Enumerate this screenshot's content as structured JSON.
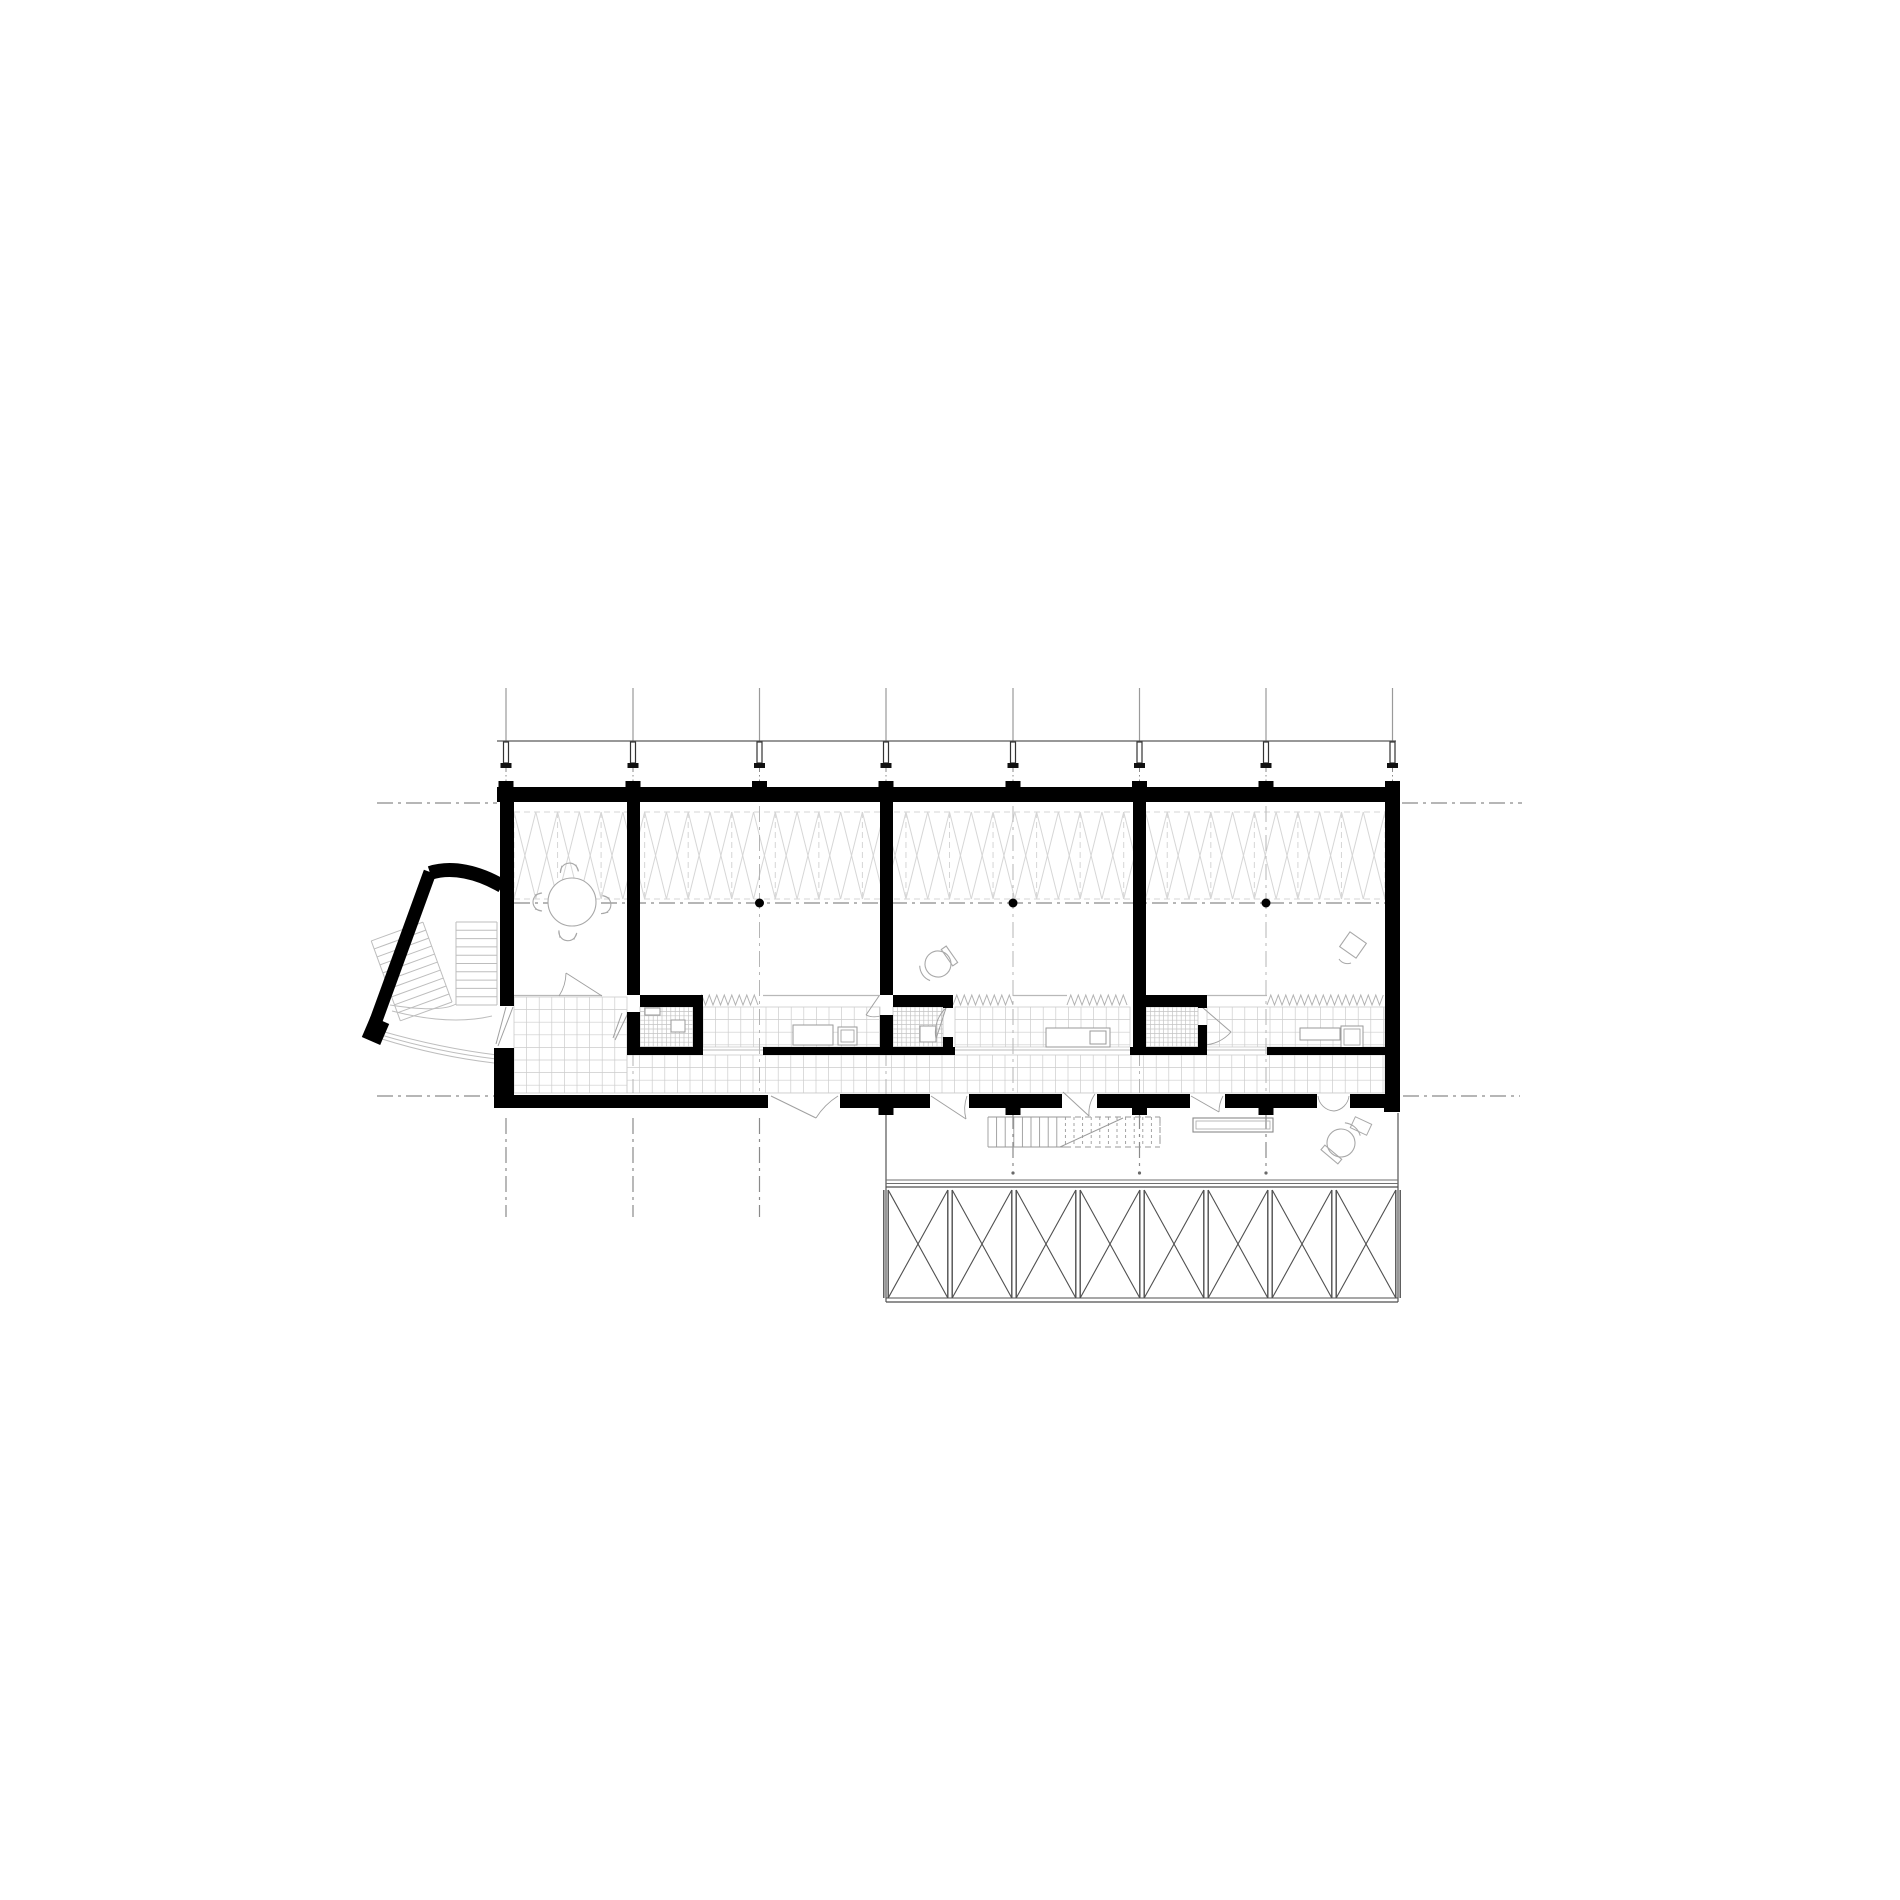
{
  "meta": {
    "type": "architectural-floor-plan",
    "canvas": {
      "w": 1900,
      "h": 1900,
      "background": "#ffffff"
    }
  },
  "colors": {
    "wall": "#000000",
    "axis": "#8a8a8a",
    "riser": "#9a9a9a",
    "canopy": "#5a5a5a",
    "truss": "#d6d6d6",
    "tile": "#cccccc",
    "tile_fine": "#c4c4c4",
    "furniture": "#a8a8a8",
    "door": "#a0a0a0",
    "deck": "#4f4f4f",
    "deck_light": "#9a9a9a",
    "stair": "#bdbdbd",
    "zigzag": "#b2b2b2",
    "fixture_border": "#9a9a9a"
  },
  "grid": {
    "x": [
      506,
      633,
      759.5,
      886,
      1013,
      1139.5,
      1266,
      1392.5
    ],
    "riser": [
      688,
      741
    ],
    "upper_dashdot": [
      768,
      787
    ],
    "interior_lines": [
      [
        2,
        806,
        1093
      ],
      [
        4,
        806,
        1093
      ],
      [
        6,
        806,
        1093
      ],
      [
        1,
        1050,
        1093
      ],
      [
        3,
        1050,
        1115
      ],
      [
        5,
        1050,
        1093
      ]
    ],
    "below_lines": [
      [
        0,
        1118,
        1217
      ],
      [
        1,
        1118,
        1217
      ],
      [
        2,
        1118,
        1217
      ]
    ],
    "deck_lines": [
      [
        4,
        1113,
        1171
      ],
      [
        5,
        1113,
        1171
      ],
      [
        6,
        1113,
        1171
      ]
    ]
  },
  "axes": {
    "horizontal": [
      {
        "name": "top-axis-left",
        "y": 803,
        "x1": 377,
        "x2": 497
      },
      {
        "name": "top-axis-right",
        "y": 803,
        "x1": 1402,
        "x2": 1522
      },
      {
        "name": "bottom-axis-left",
        "y": 1096,
        "x1": 377,
        "x2": 498
      },
      {
        "name": "bottom-axis-right",
        "y": 1096,
        "x1": 1403,
        "x2": 1520
      },
      {
        "name": "mid-axis",
        "y": 903,
        "x1": 514,
        "x2": 1385
      }
    ],
    "dots": [
      [
        759.5,
        903
      ],
      [
        1013,
        903
      ],
      [
        1266,
        903
      ]
    ]
  },
  "canopy": {
    "y": 741,
    "x1": 497,
    "x2": 1396
  },
  "columns": {
    "shaft_w": 5,
    "y1": 742,
    "y2": 763,
    "flange_w": 11,
    "flange_h": 5,
    "pad": {
      "y": 781,
      "w": 15,
      "h": 6
    }
  },
  "walls": {
    "rects": [
      [
        497,
        787,
        903,
        15,
        "top-exterior-wall"
      ],
      [
        500,
        787,
        14,
        219,
        "left-exterior-wall"
      ],
      [
        494,
        1048,
        20,
        60,
        "left-entry-pier"
      ],
      [
        1385,
        787,
        15,
        325,
        "right-exterior-wall"
      ],
      [
        498,
        1095,
        270,
        13,
        "bottom-exterior-wall-solid"
      ],
      [
        1384,
        1095,
        16,
        17,
        "bottom-right-corner"
      ],
      [
        627,
        800,
        13,
        195,
        "partition-wall-g2"
      ],
      [
        627,
        1012,
        13,
        36,
        "partition-stub-g2"
      ],
      [
        880,
        800,
        13,
        195,
        "partition-wall-g4"
      ],
      [
        880,
        1015,
        13,
        33,
        "partition-stub-g4"
      ],
      [
        1133,
        800,
        13,
        248,
        "partition-wall-g6"
      ],
      [
        640,
        995,
        63,
        12,
        "bath1-north-wall"
      ],
      [
        693,
        1005,
        10,
        43,
        "bath1-east-wall"
      ],
      [
        893,
        995,
        59,
        12,
        "bath3-north-wall"
      ],
      [
        943,
        995,
        10,
        13,
        "bath3-east-stub-top"
      ],
      [
        943,
        1037,
        10,
        11,
        "bath3-east-stub-bottom"
      ],
      [
        1146,
        995,
        61,
        12,
        "bath4-north-wall"
      ],
      [
        1198,
        995,
        9,
        13,
        "bath4-east-stub-top"
      ],
      [
        1198,
        1025,
        9,
        23,
        "bath4-east-wall"
      ],
      [
        627,
        1047,
        76,
        8,
        "strip-south-wall-1"
      ],
      [
        763,
        1047,
        192,
        8,
        "strip-south-wall-2"
      ],
      [
        1130,
        1047,
        77,
        8,
        "strip-south-wall-3"
      ],
      [
        1267,
        1047,
        119,
        8,
        "strip-south-wall-4"
      ]
    ],
    "vestibule_arc": "M430,873 C452,866 478,872 502,886",
    "vestibule_wall": [
      430,
      872,
      374,
      1026
    ],
    "vestibule_end_stub": [
      380,
      1020,
      371,
      1041
    ]
  },
  "facade": {
    "y": 1094,
    "h": 14,
    "panels": [
      [
        840,
        930
      ],
      [
        969,
        1062
      ],
      [
        1097,
        1190
      ],
      [
        1225,
        1317
      ],
      [
        1350,
        1386
      ]
    ],
    "stub": {
      "y": 1107,
      "w": 15,
      "h": 8
    },
    "stubs_x": [
      886,
      1013,
      1139.5,
      1266
    ]
  },
  "interior": {
    "south_y": 995.5,
    "south_lines": [
      [
        514,
        602
      ],
      [
        763,
        880
      ],
      [
        1013,
        1067
      ],
      [
        1207,
        1267
      ]
    ],
    "thin_bottom_y": 1050,
    "thin_bottom_lines": [
      [
        703,
        763
      ],
      [
        955,
        1130
      ],
      [
        1207,
        1267
      ]
    ],
    "zigzag": {
      "y_top": 995,
      "y_bot": 1005,
      "pitch": 7.5,
      "segments": [
        [
          698,
          760
        ],
        [
          953,
          1013
        ],
        [
          1067,
          1130
        ],
        [
          1267,
          1385
        ]
      ]
    },
    "tiles_medium": {
      "size": 12.6,
      "areas": [
        [
          514,
          997,
          113,
          96
        ],
        [
          627,
          1055,
          758,
          38
        ],
        [
          703,
          1007,
          177,
          40
        ],
        [
          955,
          1007,
          175,
          40
        ],
        [
          1207,
          1007,
          178,
          40
        ]
      ]
    },
    "tiles_fine": {
      "size": 4.4,
      "areas": [
        [
          640,
          1007,
          53,
          40
        ],
        [
          893,
          1007,
          50,
          40
        ],
        [
          1146,
          1007,
          52,
          40
        ]
      ]
    },
    "fixtures": [
      [
        645,
        1008,
        15,
        7,
        "bath1-sink"
      ],
      [
        671,
        1020,
        14,
        12,
        "bath1-toilet"
      ],
      [
        793,
        1025,
        40,
        20,
        "room2-counter"
      ],
      [
        838,
        1027,
        19,
        18,
        "room2-toilet"
      ],
      [
        920,
        1026,
        16,
        16,
        "bath3-toilet"
      ],
      [
        1046,
        1028,
        64,
        19,
        "room3-counter"
      ],
      [
        1090,
        1031,
        16,
        13,
        "room3-sink"
      ],
      [
        1300,
        1028,
        40,
        12,
        "room4-counter"
      ],
      [
        1341,
        1026,
        22,
        22,
        "room4-shower"
      ]
    ]
  },
  "truss": {
    "x1": 514,
    "x2": 1385,
    "y1": 812,
    "y2": 899,
    "cells": 20
  },
  "deck": {
    "left": 886,
    "right": 1398,
    "strip_y1": 1113,
    "floor_lines_y": [
      1180,
      1183.5
    ],
    "band": {
      "top_y": 1187,
      "y1": 1190,
      "y2": 1298,
      "bottom_y": 1302,
      "posts": [
        886,
        950,
        1014,
        1078,
        1142,
        1206,
        1270,
        1334,
        1398
      ]
    },
    "stair": {
      "x1": 988,
      "x2": 1160,
      "y1": 1117,
      "y2": 1147,
      "solid_until": 1065,
      "tread": 8.6,
      "diagonal": [
        1060,
        1147,
        1123,
        1118
      ]
    },
    "bench": [
      1193,
      1118,
      80,
      14
    ],
    "armchair": {
      "cx": 1341,
      "cy": 1143,
      "r": 14,
      "rot": 130
    },
    "side_table": {
      "x": 1352,
      "y": 1120,
      "w": 18,
      "h": 12,
      "rot": 25
    }
  },
  "furniture": {
    "round_table": {
      "cx": 572,
      "cy": 902,
      "r": 24,
      "chair_angles": [
        95,
        180,
        355,
        262
      ],
      "chair_dist": 32
    },
    "office_chair_room3": {
      "cx": 938,
      "cy": 964,
      "r": 13,
      "rot": -35
    },
    "desk_room4": {
      "cx": 1353,
      "cy": 945,
      "w": 20,
      "h": 18,
      "rot": 35
    }
  },
  "vestibule_stair": {
    "straight": {
      "x1": 456,
      "x2": 497,
      "y1": 922,
      "y2": 1005,
      "step": 8.3
    },
    "angled": {
      "px": 452,
      "py": 1002,
      "w": 55,
      "h": 85,
      "rot": -20,
      "step": 8.5
    },
    "arcs": [
      "M390,1005 Q440,1013 456,1004",
      "M392,1011 Q450,1026 492,1016",
      "M381,1031 Q440,1048 497,1055",
      "M381,1035 Q438,1052 496,1059",
      "M382,1039 Q436,1056 494,1063"
    ]
  },
  "doors": [
    {
      "name": "entry-door",
      "lines": [
        [
          513,
          1007,
          498,
          1046
        ],
        [
          506,
          1007,
          496,
          1044
        ]
      ],
      "arcs": []
    },
    {
      "name": "room1-south-door",
      "lines": [
        [
          602,
          996,
          566,
          973
        ]
      ],
      "arcs": [
        "M566,973 A43,43 0 0 1 559,996"
      ]
    },
    {
      "name": "bath1-door",
      "lines": [
        [
          628,
          1013,
          615,
          1040
        ],
        [
          622,
          1013,
          613,
          1038
        ]
      ],
      "arcs": []
    },
    {
      "name": "room2-strip-door",
      "lines": [
        [
          879,
          996,
          866,
          1015
        ]
      ],
      "arcs": [
        "M866,1015 A20,20 0 0 0 880,1016"
      ]
    },
    {
      "name": "bath3-door",
      "lines": [
        [
          946,
          1008,
          936,
          1039
        ]
      ],
      "arcs": [
        "M936,1039 A33,33 0 0 1 946,1008"
      ]
    },
    {
      "name": "bath4-door",
      "lines": [
        [
          1202,
          1007,
          1231,
          1032
        ]
      ],
      "arcs": [
        "M1231,1032 A38,38 0 0 1 1202, 1045"
      ]
    },
    {
      "name": "facade-door-1",
      "lines": [
        [
          771,
          1096,
          816,
          1118
        ]
      ],
      "arcs": [
        "M816,1118 A70,70 0 0 1 838,1096"
      ]
    },
    {
      "name": "facade-door-2",
      "lines": [
        [
          931,
          1096,
          966,
          1119
        ]
      ],
      "arcs": [
        "M966,1119 A38,38 0 0 1 967,1096"
      ]
    },
    {
      "name": "facade-door-3",
      "lines": [
        [
          1063,
          1092,
          1089,
          1116
        ]
      ],
      "arcs": [
        "M1089,1116 A34,34 0 0 1 1095,1094"
      ]
    },
    {
      "name": "facade-door-4",
      "lines": [
        [
          1191,
          1096,
          1219,
          1112
        ]
      ],
      "arcs": [
        "M1219,1112 A33,33 0 0 1 1223,1096"
      ]
    },
    {
      "name": "facade-door-5",
      "lines": [],
      "arcs": [
        "M1318,1096 A17,17 0 0 0 1334,1111",
        "M1349,1096 A17,17 0 0 1 1334,1111"
      ]
    }
  ]
}
